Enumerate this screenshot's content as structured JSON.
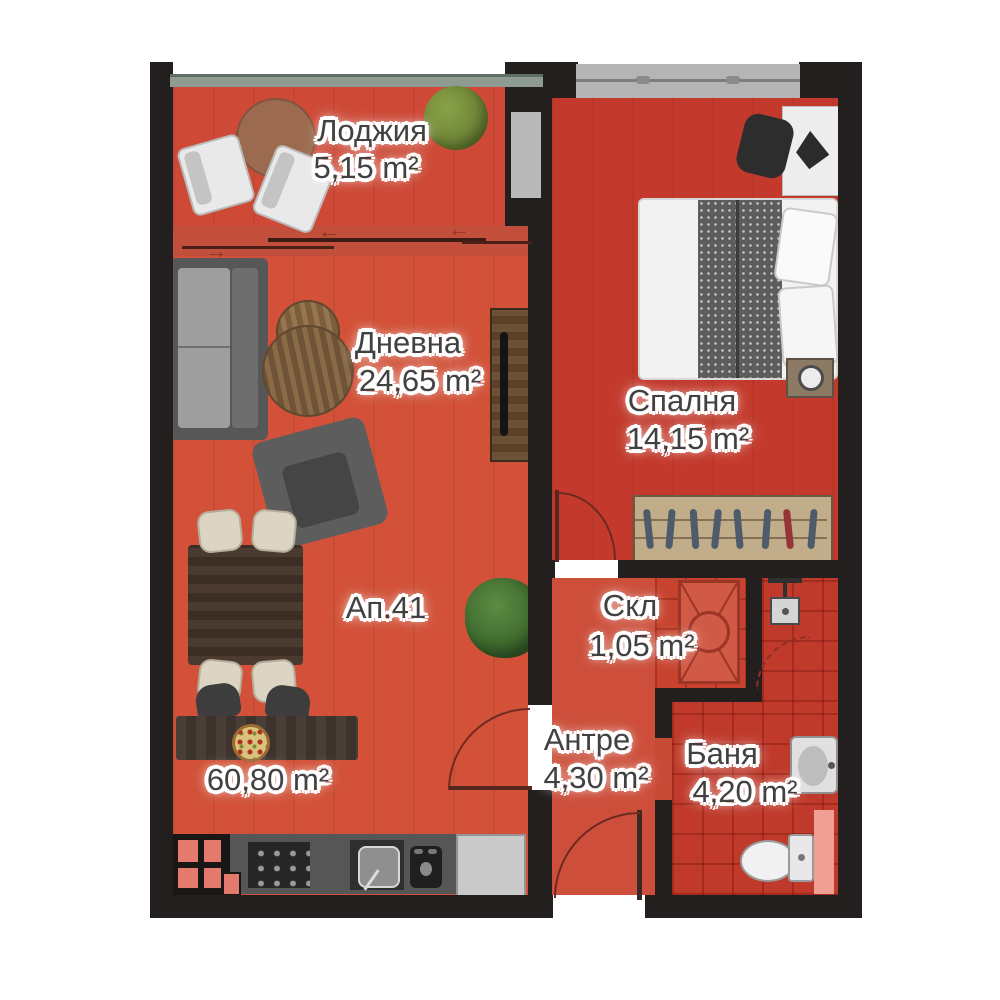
{
  "plan": {
    "apartment_label": "Ап.41",
    "total_area": "60,80",
    "unit": "m²",
    "rooms": [
      {
        "name": "Лоджия",
        "area": "5,15"
      },
      {
        "name": "Дневна",
        "area": "24,65"
      },
      {
        "name": "Спалня",
        "area": "14,15"
      },
      {
        "name": "Скл",
        "area": "1,05"
      },
      {
        "name": "Антре",
        "area": "4,30"
      },
      {
        "name": "Баня",
        "area": "4,20"
      }
    ],
    "colors": {
      "wall": "#231f1e",
      "living_floor": "#d25138",
      "loggia_floor": "#ce4a37",
      "bedroom_floor": "#c33a2c",
      "hall_floor": "#cd4e3a",
      "storage_floor": "#c7432f",
      "bath_floor": "#c03a2b",
      "window_gray": "#b5b5b5",
      "label_text": "#414141",
      "label_halo": "#ffffff"
    }
  }
}
